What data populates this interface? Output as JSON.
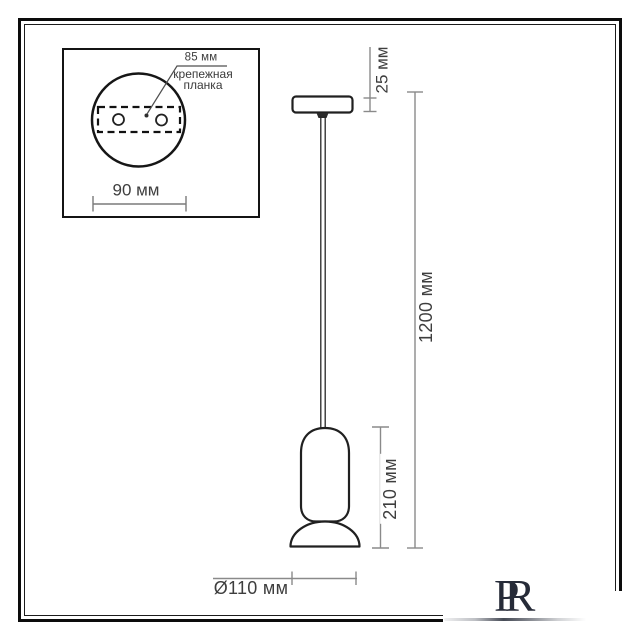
{
  "drawing": {
    "inset": {
      "plate_width_label": "85 мм",
      "plate_name_line1": "крепежная",
      "plate_name_line2": "планка",
      "canopy_diameter_label": "90 мм"
    },
    "dimensions": {
      "canopy_height": "25 мм",
      "suspension_length": "1200 мм",
      "shade_height": "210 мм",
      "shade_diameter": "Ø110 мм"
    }
  },
  "logo": {
    "letter_1": "P",
    "letter_2": "R"
  },
  "colors": {
    "outline": "#202020",
    "dimension_line": "#8a8a8a",
    "text": "#3e3e3e",
    "logo": "#262b38",
    "background": "#ffffff"
  }
}
